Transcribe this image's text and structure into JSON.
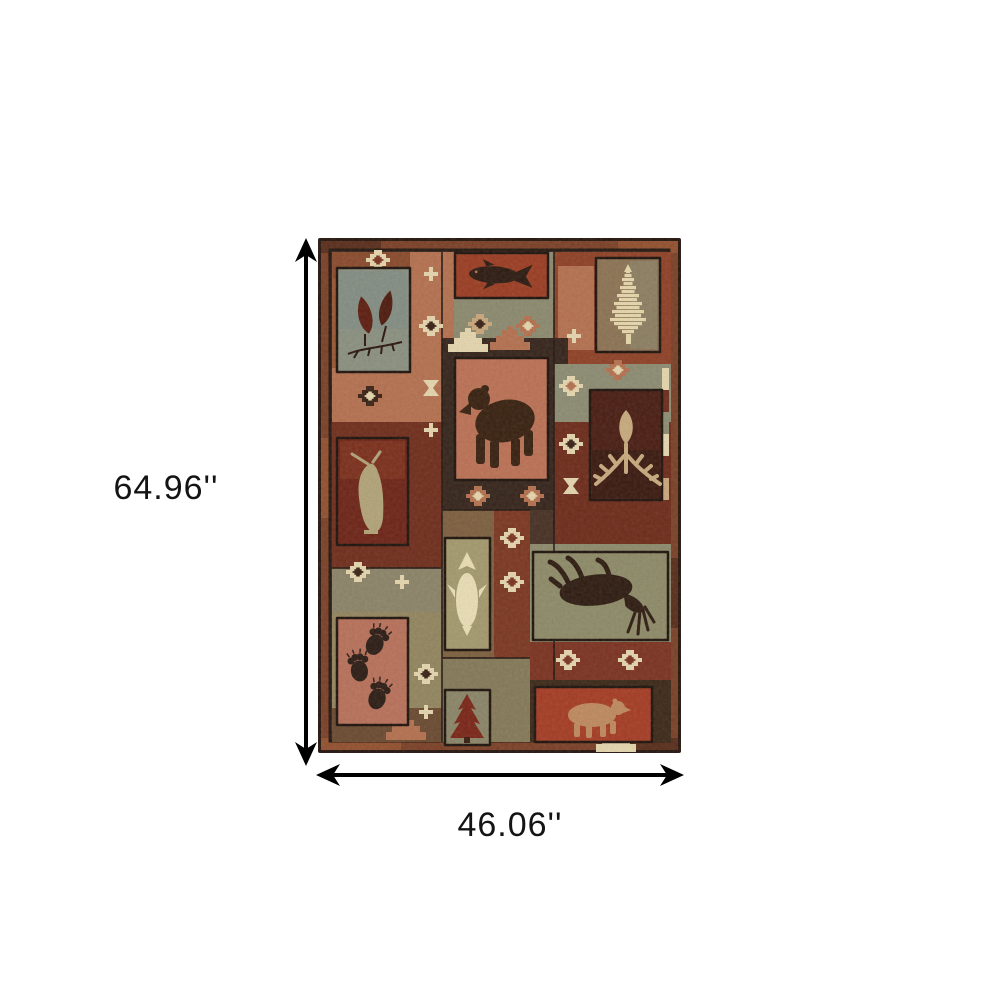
{
  "figure": {
    "description": "Product dimension image of a rustic lodge-style patchwork area rug with wildlife and southwestern motifs on a white background",
    "background_color": "#ffffff",
    "arrow_color": "#000000"
  },
  "dimensions": {
    "height_label": "64.96''",
    "width_label": "46.06''"
  },
  "rug": {
    "motifs": [
      "maple-leaf-branch",
      "fish",
      "ikat-pine-tree",
      "black-bear",
      "deer-antlers",
      "standing-bird",
      "vertical-fish",
      "moose",
      "bear-paw-prints",
      "pine-tree",
      "walking-bear",
      "stepped-diamonds",
      "hourglass",
      "cross-flower",
      "stepped-pyramids"
    ],
    "palette": {
      "rust_red": "#8f4126",
      "terracotta_salmon": "#bc7154",
      "dark_brown": "#35241a",
      "sage_green": "#8d8c72",
      "olive": "#8b8468",
      "cream": "#e6d7ae",
      "tan": "#c9ab7e",
      "dark_maroon": "#5a2115",
      "border_rust": "#7c4026"
    }
  }
}
